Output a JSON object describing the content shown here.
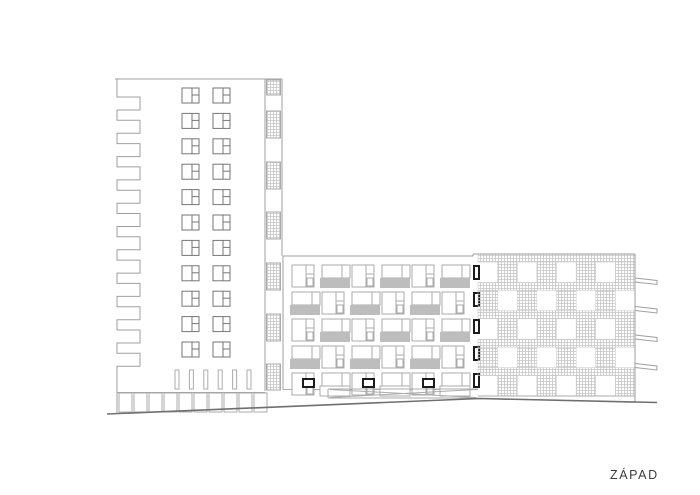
{
  "page": {
    "width": 700,
    "height": 495,
    "background": "#ffffff"
  },
  "label": {
    "text": "ZÁPAD"
  },
  "colors": {
    "line": "#9f9f9f",
    "frame": "#767676",
    "light_frame": "#ababab",
    "slab_gray": "#bdbdbd",
    "black": "#1b1b1b",
    "hatch": "#c6c6c6",
    "ground": "#6f6f6f",
    "white": "#ffffff"
  },
  "tower": {
    "left": 117,
    "right": 282,
    "top": 79,
    "teeth": {
      "x_out": 117,
      "x_in": 140,
      "start": 97,
      "period": 23.3,
      "depth": 13,
      "count": 12
    },
    "windows": {
      "cols": [
        182,
        213
      ],
      "row_start": 88,
      "row_step": 25.4,
      "rows": 11,
      "w": 17,
      "h": 15
    },
    "strip": {
      "x1": 265,
      "x2": 282,
      "top": 79,
      "bottom": 391,
      "panels": [
        [
          80,
          95
        ],
        [
          111,
          138
        ],
        [
          162,
          189
        ],
        [
          212,
          239
        ],
        [
          263,
          290
        ],
        [
          314,
          341
        ],
        [
          364,
          390
        ]
      ]
    },
    "slats": {
      "start_x": 175,
      "step": 14.4,
      "count": 6,
      "w": 4,
      "y1": 370,
      "y2": 389
    },
    "base": {
      "line_y": 392.5,
      "panel_y": 393,
      "panel_h": 19,
      "panel_w": 13,
      "panel_step": 15,
      "panel_start": 119,
      "panel_count": 10,
      "bottom": 414
    }
  },
  "middle": {
    "left": 283,
    "right": 478,
    "top": 256,
    "bottom": 389.5,
    "grid": {
      "col_start": 292,
      "col_step": 30,
      "cols": 6,
      "row_start": 265,
      "row_step": 27,
      "rows": 5
    },
    "winA": {
      "w": 22,
      "h": 22,
      "vdiv": 14,
      "hdiv": 9,
      "inset_y": 13
    },
    "winB": {
      "w": 28,
      "h": 13,
      "vdiv": 20,
      "slab_h": 10
    },
    "doors": {
      "dx": 11,
      "dy": 6,
      "w": 11,
      "h": 8
    },
    "edge_marks": {
      "x": 474,
      "w": 5,
      "h": 13,
      "dy": 1
    }
  },
  "right_building": {
    "left": 478,
    "right": 635,
    "top": 254,
    "bottom": 396,
    "top_line_x1": 473,
    "floors": 5,
    "floor_h": 28.4,
    "band_h": 8,
    "cell_cols": 8,
    "balconies": {
      "x": 635,
      "len": 22,
      "ys": [
        278,
        306.5,
        335,
        363.5
      ]
    },
    "ground_y": 402.5
  },
  "ramp": {
    "x1": 328,
    "x2": 478,
    "y1": 389,
    "y2": 398
  },
  "ground": {
    "points": [
      [
        107,
        414
      ],
      [
        480,
        398.5
      ],
      [
        657,
        402.5
      ]
    ]
  }
}
